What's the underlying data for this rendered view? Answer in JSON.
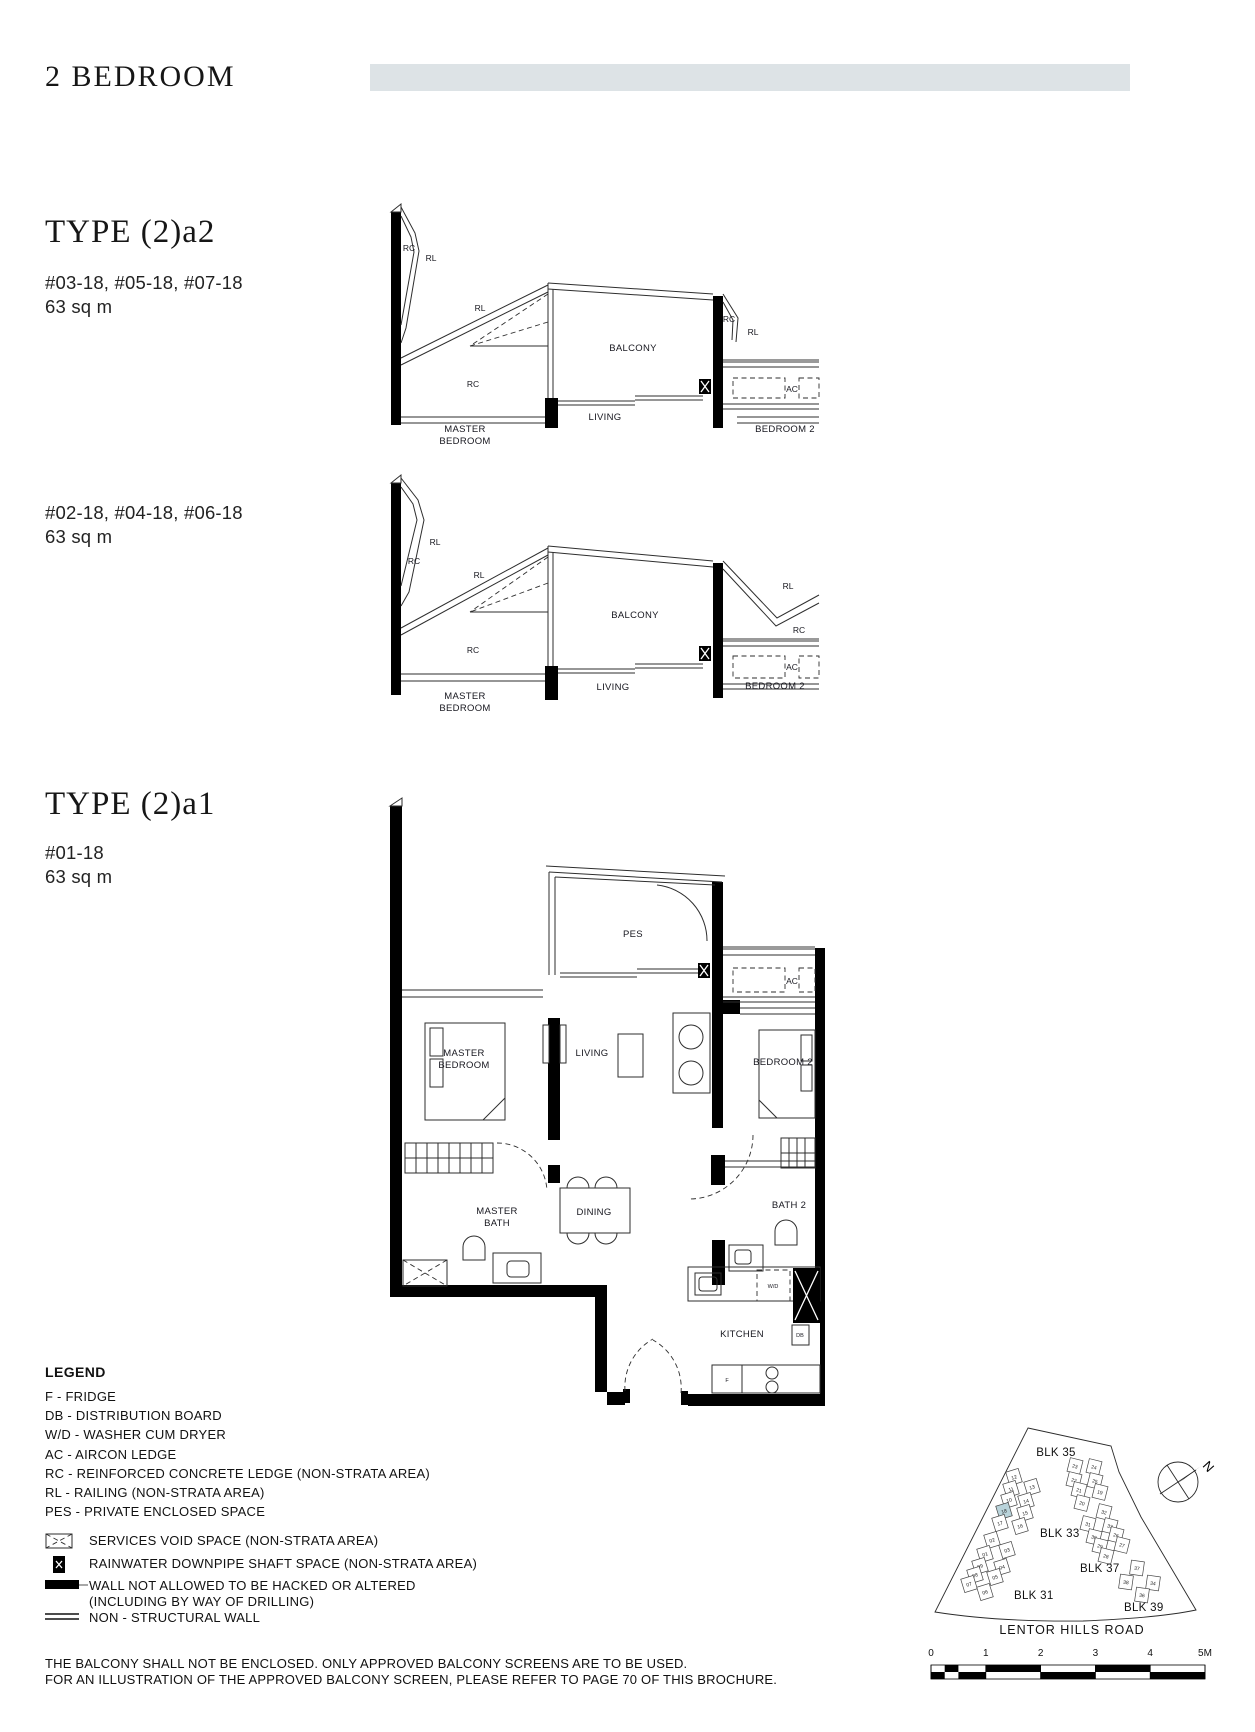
{
  "page": {
    "title": "2 BEDROOM",
    "accent_bar_color": "#dde3e6",
    "disclaimer_line1": "THE BALCONY SHALL NOT BE ENCLOSED. ONLY APPROVED BALCONY SCREENS ARE TO BE USED.",
    "disclaimer_line2": "FOR AN ILLUSTRATION OF THE APPROVED BALCONY SCREEN, PLEASE REFER TO PAGE 70 OF THIS BROCHURE."
  },
  "types": {
    "a2": {
      "title": "TYPE (2)a2",
      "variant_upper": {
        "units": "#03-18, #05-18, #07-18",
        "area": "63 sq m"
      },
      "variant_lower": {
        "units": "#02-18, #04-18, #06-18",
        "area": "63 sq m"
      }
    },
    "a1": {
      "title": "TYPE (2)a1",
      "units": "#01-18",
      "area": "63 sq m"
    }
  },
  "labels": {
    "balcony": "BALCONY",
    "living": "LIVING",
    "master1": "MASTER",
    "master2": "BEDROOM",
    "bedroom2": "BEDROOM 2",
    "rc": "RC",
    "rl": "RL",
    "ac": "AC",
    "pes": "PES",
    "dining": "DINING",
    "mbath1": "MASTER",
    "mbath2": "BATH",
    "bath2": "BATH 2",
    "kitchen": "KITCHEN",
    "wd": "W/D",
    "db": "DB",
    "f": "F"
  },
  "legend": {
    "title": "LEGEND",
    "items": [
      "F - FRIDGE",
      "DB - DISTRIBUTION BOARD",
      "W/D - WASHER CUM DRYER",
      "AC - AIRCON LEDGE",
      "RC - REINFORCED CONCRETE LEDGE (NON-STRATA AREA)",
      "RL - RAILING (NON-STRATA AREA)",
      "PES - PRIVATE ENCLOSED SPACE"
    ],
    "symbol_items": [
      {
        "icon": "services-void-icon",
        "label": "SERVICES VOID SPACE (NON-STRATA AREA)"
      },
      {
        "icon": "rainwater-downpipe-icon",
        "label": "RAINWATER DOWNPIPE SHAFT SPACE (NON-STRATA AREA)"
      },
      {
        "icon": "no-hack-wall-icon",
        "label": "WALL NOT ALLOWED TO BE HACKED OR ALTERED",
        "label2": "(INCLUDING BY WAY OF DRILLING)"
      },
      {
        "icon": "non-structural-wall-icon",
        "label": "NON - STRUCTURAL WALL"
      }
    ]
  },
  "site_plan": {
    "road_label": "LENTOR HILLS ROAD",
    "north_label": "N",
    "highlight_color": "#b9d3da",
    "block_labels": [
      {
        "text": "BLK 35",
        "x": 228,
        "y": 36
      },
      {
        "text": "BLK 33",
        "x": 212,
        "y": 117
      },
      {
        "text": "BLK 37",
        "x": 252,
        "y": 152
      },
      {
        "text": "BLK 31",
        "x": 186,
        "y": 179
      },
      {
        "text": "BLK 39",
        "x": 296,
        "y": 191
      }
    ],
    "scale_ticks": [
      "0",
      "1",
      "2",
      "3",
      "4",
      "5M"
    ],
    "clusters": [
      {
        "name": "blk-33",
        "rot": -17,
        "units": [
          {
            "label": "12",
            "x": 186,
            "y": 57
          },
          {
            "label": "11",
            "x": 183,
            "y": 69
          },
          {
            "label": "13",
            "x": 204,
            "y": 67
          },
          {
            "label": "10",
            "x": 181,
            "y": 80
          },
          {
            "label": "14",
            "x": 198,
            "y": 81
          },
          {
            "label": "18",
            "x": 176,
            "y": 91,
            "highlight": true
          },
          {
            "label": "15",
            "x": 197,
            "y": 93
          },
          {
            "label": "17",
            "x": 172,
            "y": 103
          },
          {
            "label": "16",
            "x": 192,
            "y": 106
          }
        ]
      },
      {
        "name": "blk-31",
        "rot": -17,
        "units": [
          {
            "label": "02",
            "x": 164,
            "y": 120
          },
          {
            "label": "03",
            "x": 179,
            "y": 130
          },
          {
            "label": "01",
            "x": 157,
            "y": 134
          },
          {
            "label": "09",
            "x": 152,
            "y": 146
          },
          {
            "label": "04",
            "x": 174,
            "y": 147
          },
          {
            "label": "08",
            "x": 147,
            "y": 155
          },
          {
            "label": "05",
            "x": 167,
            "y": 157
          },
          {
            "label": "07",
            "x": 141,
            "y": 164
          },
          {
            "label": "06",
            "x": 157,
            "y": 172
          }
        ]
      },
      {
        "name": "blk-35",
        "rot": 14,
        "units": [
          {
            "label": "23",
            "x": 247,
            "y": 46
          },
          {
            "label": "24",
            "x": 266,
            "y": 47
          },
          {
            "label": "22",
            "x": 246,
            "y": 60
          },
          {
            "label": "25",
            "x": 267,
            "y": 61
          },
          {
            "label": "21",
            "x": 251,
            "y": 70
          },
          {
            "label": "19",
            "x": 272,
            "y": 72
          },
          {
            "label": "20",
            "x": 254,
            "y": 83
          }
        ]
      },
      {
        "name": "blk-37",
        "rot": 14,
        "units": [
          {
            "label": "32",
            "x": 276,
            "y": 92
          },
          {
            "label": "31",
            "x": 260,
            "y": 104
          },
          {
            "label": "33",
            "x": 282,
            "y": 106
          },
          {
            "label": "30",
            "x": 266,
            "y": 117
          },
          {
            "label": "26",
            "x": 288,
            "y": 115
          },
          {
            "label": "29",
            "x": 272,
            "y": 126
          },
          {
            "label": "27",
            "x": 294,
            "y": 125
          },
          {
            "label": "28",
            "x": 278,
            "y": 136
          }
        ]
      },
      {
        "name": "blk-39",
        "rot": 8,
        "units": [
          {
            "label": "37",
            "x": 309,
            "y": 148
          },
          {
            "label": "38",
            "x": 298,
            "y": 162
          },
          {
            "label": "34",
            "x": 325,
            "y": 163
          },
          {
            "label": "36",
            "x": 314,
            "y": 175
          }
        ]
      }
    ]
  }
}
